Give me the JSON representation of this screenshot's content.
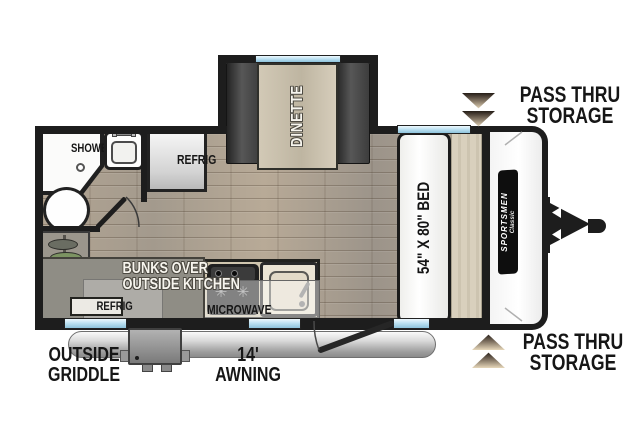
{
  "floorplan": {
    "shower": "SHOWER",
    "bath_refrig": "REFRIG",
    "dinette": "DINETTE",
    "bed": "54\" X 80\" BED",
    "microwave": "MICROWAVE",
    "bunks_line1": "BUNKS OVER",
    "bunks_line2": "OUTSIDE KITCHEN",
    "bunks_refrig": "REFRIG",
    "brand_name": "SPORTSMEN",
    "brand_series": "Classic"
  },
  "callouts": {
    "pass_thru_top_1": "PASS THRU",
    "pass_thru_top_2": "STORAGE",
    "pass_thru_bottom_1": "PASS THRU",
    "pass_thru_bottom_2": "STORAGE",
    "griddle_1": "OUTSIDE",
    "griddle_2": "GRIDDLE",
    "awning_1": "14'",
    "awning_2": "AWNING"
  },
  "colors": {
    "wall": "#1d1d1d",
    "floor_wood": "#b1a493",
    "window_blue": "#a9d6ea",
    "bench_gray": "#454545",
    "wood_tan": "#ccc3af",
    "bunks_gray": "#8f8d85",
    "arrow_brown": "#8d7f6d",
    "label_black": "#161616"
  }
}
